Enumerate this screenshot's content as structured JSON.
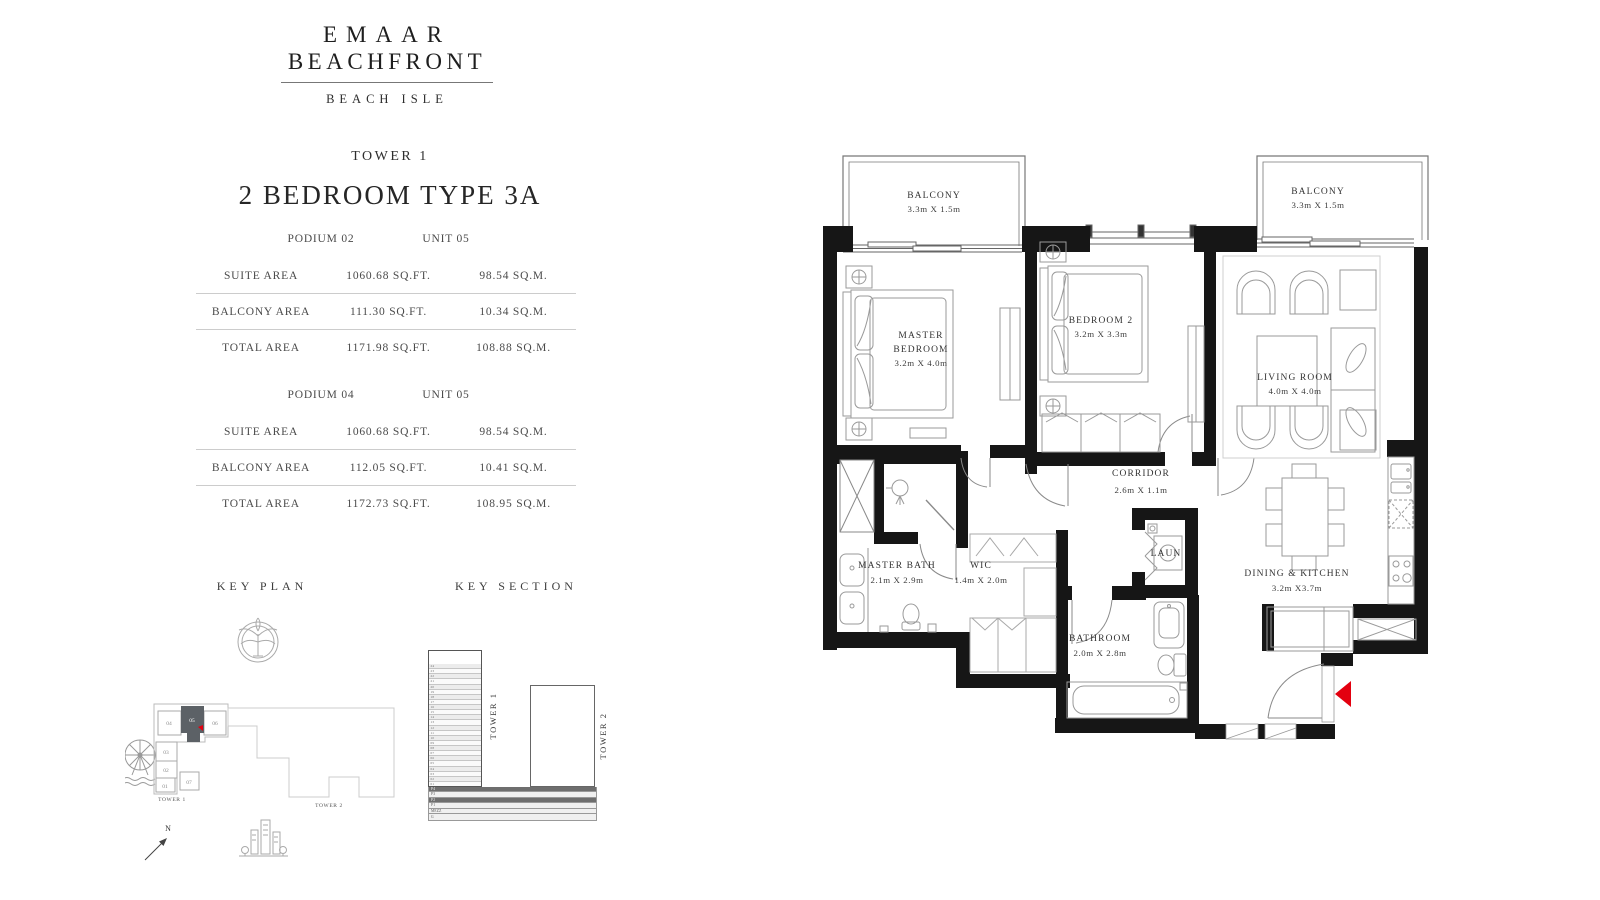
{
  "brand": {
    "line1": "EMAAR",
    "line2": "BEACHFRONT",
    "sub": "BEACH ISLE"
  },
  "unit": {
    "tower": "TOWER 1",
    "title": "2 BEDROOM TYPE 3A"
  },
  "tables": [
    {
      "podium": "PODIUM 02",
      "unit": "UNIT 05",
      "rows": [
        {
          "label": "SUITE AREA",
          "sqft": "1060.68 SQ.FT.",
          "sqm": "98.54 SQ.M."
        },
        {
          "label": "BALCONY AREA",
          "sqft": "111.30 SQ.FT.",
          "sqm": "10.34 SQ.M."
        },
        {
          "label": "TOTAL AREA",
          "sqft": "1171.98 SQ.FT.",
          "sqm": "108.88 SQ.M."
        }
      ]
    },
    {
      "podium": "PODIUM 04",
      "unit": "UNIT 05",
      "rows": [
        {
          "label": "SUITE AREA",
          "sqft": "1060.68 SQ.FT.",
          "sqm": "98.54 SQ.M."
        },
        {
          "label": "BALCONY AREA",
          "sqft": "112.05 SQ.FT.",
          "sqm": "10.41 SQ.M."
        },
        {
          "label": "TOTAL AREA",
          "sqft": "1172.73 SQ.FT.",
          "sqm": "108.95 SQ.M."
        }
      ]
    }
  ],
  "key_plan": {
    "heading": "KEY PLAN",
    "tower1_label": "TOWER 1",
    "tower2_label": "TOWER 2",
    "north": "N",
    "units": [
      "01",
      "02",
      "03",
      "04",
      "05",
      "06",
      "07"
    ],
    "highlighted_unit": "05",
    "highlight_color": "#5c6166",
    "marker_color": "#e3000f"
  },
  "key_section": {
    "heading": "KEY SECTION",
    "tower1_label": "TOWER 1",
    "tower2_label": "TOWER 2",
    "floors": [
      "24",
      "23",
      "22",
      "21",
      "20",
      "19",
      "18",
      "17",
      "16",
      "15",
      "14",
      "13",
      "12",
      "11",
      "10",
      "09",
      "08",
      "07",
      "06",
      "05",
      "04",
      "03",
      "02",
      "01"
    ],
    "podium": [
      {
        "label": "P4",
        "dark": true
      },
      {
        "label": "P3",
        "dark": false
      },
      {
        "label": "P2",
        "dark": true
      },
      {
        "label": "P1",
        "dark": false
      },
      {
        "label": "MEZZ",
        "dark": false
      },
      {
        "label": "G",
        "dark": false
      }
    ]
  },
  "floor_plan": {
    "entry_marker_color": "#e3000f",
    "rooms": {
      "balcony_left": {
        "name": "BALCONY",
        "dims": "3.3m X 1.5m"
      },
      "balcony_right": {
        "name": "BALCONY",
        "dims": "3.3m X 1.5m"
      },
      "master_bedroom": {
        "name_line1": "MASTER",
        "name_line2": "BEDROOM",
        "dims": "3.2m X 4.0m"
      },
      "bedroom_2": {
        "name": "BEDROOM 2",
        "dims": "3.2m X 3.3m"
      },
      "living_room": {
        "name": "LIVING ROOM",
        "dims": "4.0m X 4.0m"
      },
      "corridor": {
        "name": "CORRIDOR",
        "dims": "2.6m X 1.1m"
      },
      "master_bath": {
        "name": "MASTER BATH",
        "dims": "2.1m X 2.9m"
      },
      "wic": {
        "name": "WIC",
        "dims": "1.4m X 2.0m"
      },
      "laundry": {
        "name": "LAUN"
      },
      "bathroom": {
        "name": "BATHROOM",
        "dims": "2.0m X 2.8m"
      },
      "dining_kitchen": {
        "name": "DINING & KITCHEN",
        "dims": "3.2m X3.7m"
      }
    }
  }
}
